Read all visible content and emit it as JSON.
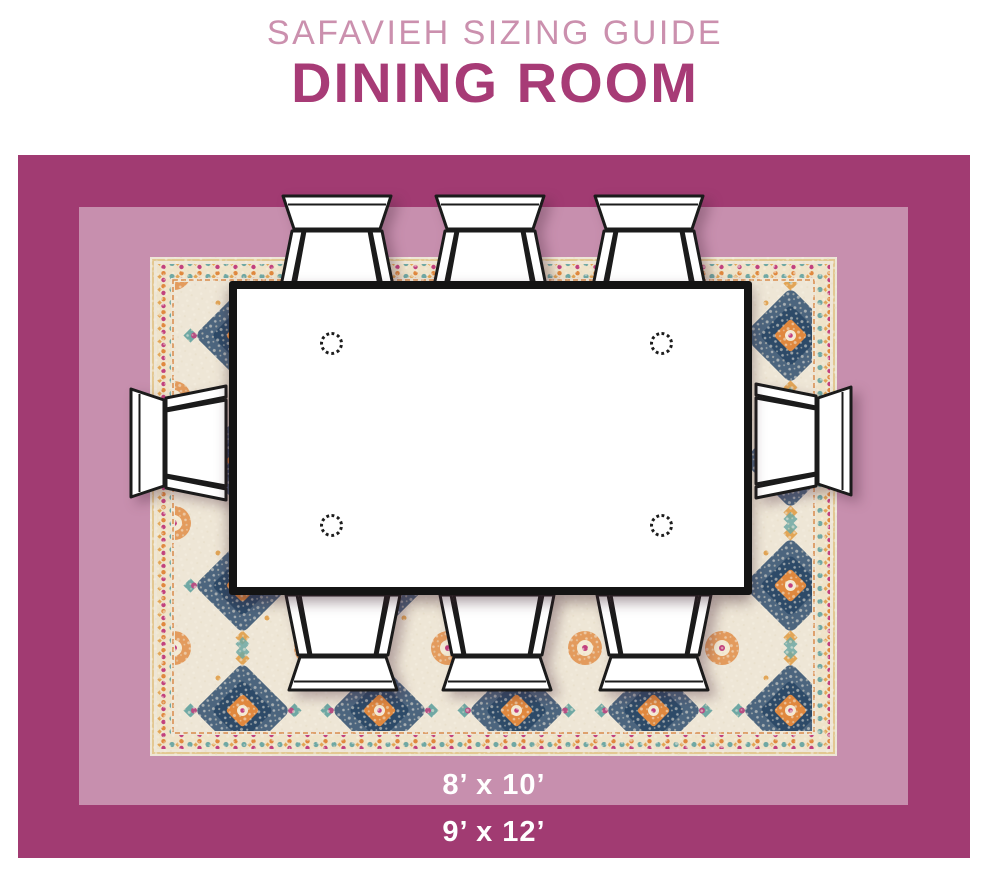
{
  "header": {
    "brand_line": "SAFAVIEH SIZING GUIDE",
    "room_line": "DINING ROOM"
  },
  "scene": {
    "inner_rug_size_label": "8’ x 10’",
    "outer_rug_size_label": "9’ x 12’",
    "chair_count": 8,
    "table_shape": "rectangle"
  },
  "colors": {
    "brand-title": "#cb90ae",
    "room-title": "#a73b76",
    "outer-band": "#a13b72",
    "inner-band": "#c78fae",
    "rug-base": "#eee6d6",
    "rug-navy": "#3e5a77",
    "rug-orange": "#e0883e",
    "rug-teal": "#6fa8a4",
    "rug-magenta": "#c2407e",
    "rug-gold": "#e2a556",
    "table-outline": "#141414",
    "label-text": "#ffffff"
  }
}
